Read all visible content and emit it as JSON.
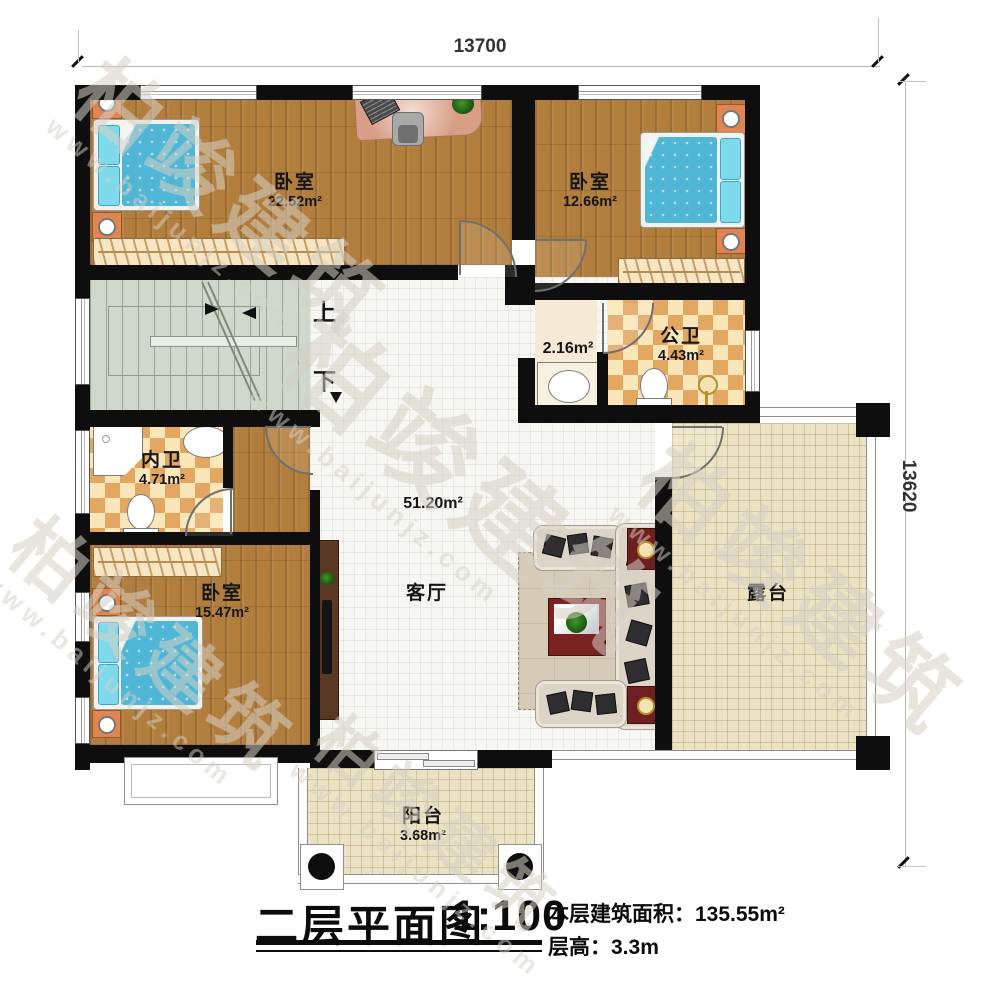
{
  "dimensions": {
    "top": "13700",
    "right": "13620"
  },
  "stairs": {
    "up": "上",
    "down": "下"
  },
  "rooms": {
    "bedroom_top_left": {
      "name": "卧室",
      "area": "22.52m²"
    },
    "bedroom_top_right": {
      "name": "卧室",
      "area": "12.66m²"
    },
    "bedroom_bottom_left": {
      "name": "卧室",
      "area": "15.47m²"
    },
    "public_bathroom": {
      "name": "公卫",
      "area": "4.43m²"
    },
    "private_bathroom": {
      "name": "内卫",
      "area": "4.71m²"
    },
    "hall_niche": {
      "area": "2.16m²"
    },
    "living_room": {
      "name": "客厅",
      "area": "51.20m²"
    },
    "terrace": {
      "name": "露台"
    },
    "balcony": {
      "name": "阳台",
      "area": "3.68m²"
    }
  },
  "title_block": {
    "title": "二层平面图",
    "scale": "1:100",
    "floor_area_label": "本层建筑面积：",
    "floor_area_value": "135.55m²",
    "floor_height_label": "层高：",
    "floor_height_value": "3.3m"
  },
  "watermark": {
    "brand": "柏竣建筑",
    "url": "www.baijunjz.com"
  },
  "colors": {
    "wall": "#0e0e0e",
    "wood_floor": "#b27e3e",
    "tile_beige": "#ebe3c4",
    "checker_tan": "#e3a761",
    "stair_green": "#cfd8cb",
    "bed_blue": "#4fb6d6",
    "sofa_cream": "#dcd5c7",
    "table_red": "#7a2121"
  }
}
